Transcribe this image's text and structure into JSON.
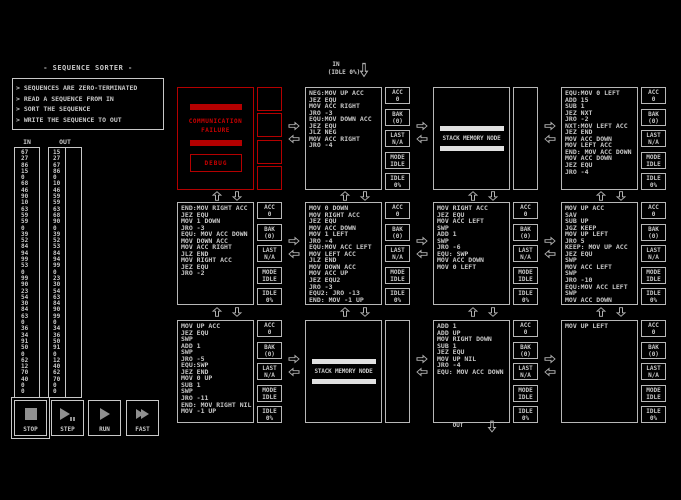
{
  "puzzle": {
    "title": "- SEQUENCE SORTER -",
    "description": [
      "> SEQUENCES ARE ZERO-TERMINATED",
      "> READ A SEQUENCE FROM IN",
      "> SORT THE SEQUENCE",
      "> WRITE THE SEQUENCE TO OUT"
    ]
  },
  "io": {
    "in_label": "IN",
    "out_label": "OUT",
    "in_values": [
      67,
      27,
      86,
      15,
      0,
      68,
      46,
      90,
      10,
      63,
      59,
      59,
      0,
      39,
      52,
      84,
      94,
      99,
      53,
      0,
      99,
      90,
      23,
      54,
      30,
      84,
      63,
      0,
      36,
      34,
      91,
      50,
      0,
      62,
      12,
      70,
      40,
      0,
      0
    ],
    "out_expected": [
      15,
      27,
      67,
      86,
      0,
      10,
      46,
      59,
      59,
      63,
      68,
      90,
      0,
      39,
      52,
      53,
      84,
      94,
      99,
      0,
      23,
      30,
      54,
      63,
      84,
      90,
      99,
      0,
      34,
      36,
      50,
      91,
      0,
      12,
      40,
      62,
      70,
      0,
      0
    ],
    "out_actual": []
  },
  "ports": {
    "in": {
      "label": "IN",
      "status": "(IDLE 0%)"
    },
    "out": {
      "label": "OUT"
    }
  },
  "status_labels": {
    "acc": "ACC",
    "bak": "BAK",
    "last": "LAST",
    "mode": "MODE",
    "idle": "IDLE"
  },
  "controls": [
    {
      "id": "stop",
      "label": "STOP",
      "active": true
    },
    {
      "id": "step",
      "label": "STEP",
      "active": false
    },
    {
      "id": "run",
      "label": "RUN",
      "active": false
    },
    {
      "id": "fast",
      "label": "FAST",
      "active": false
    }
  ],
  "nodes": [
    {
      "row": 0,
      "col": 0,
      "type": "corrupt",
      "lines": [
        "COMMUNICATION",
        "FAILURE"
      ],
      "button": "DEBUG"
    },
    {
      "row": 0,
      "col": 1,
      "type": "code",
      "code": [
        "NEG:MOV UP ACC",
        "JEZ EQU",
        "MOV ACC RIGHT",
        "JRO -3",
        "EQU:MOV DOWN ACC",
        "JEZ EQU",
        "JLZ NEG",
        "MOV ACC RIGHT",
        "JRO -4"
      ],
      "status": {
        "acc": "0",
        "bak": "(0)",
        "last": "N/A",
        "mode": "IDLE",
        "idle": "0%"
      }
    },
    {
      "row": 0,
      "col": 2,
      "type": "stack",
      "label": "STACK MEMORY NODE"
    },
    {
      "row": 0,
      "col": 3,
      "type": "code",
      "code": [
        "EQU:MOV 0 LEFT",
        "ADD 15",
        "SUB 1",
        "JEZ NXT",
        "JRO -2",
        "NXT:MOV LEFT ACC",
        "JEZ END",
        "MOV ACC DOWN",
        "MOV LEFT ACC",
        "END: MOV ACC DOWN",
        "MOV ACC DOWN",
        "JEZ EQU",
        "JRO -4"
      ],
      "status": {
        "acc": "0",
        "bak": "(0)",
        "last": "N/A",
        "mode": "IDLE",
        "idle": "0%"
      }
    },
    {
      "row": 1,
      "col": 0,
      "type": "code",
      "code": [
        "END:MOV RIGHT ACC",
        "JEZ EQU",
        "MOV 1 DOWN",
        "JRO -3",
        "EQU: MOV ACC DOWN",
        "MOV DOWN ACC",
        "MOV ACC RIGHT",
        "JLZ END",
        "MOV RIGHT ACC",
        "JEZ EQU",
        "JRO -2"
      ],
      "status": {
        "acc": "0",
        "bak": "(0)",
        "last": "N/A",
        "mode": "IDLE",
        "idle": "0%"
      }
    },
    {
      "row": 1,
      "col": 1,
      "type": "code",
      "code": [
        "MOV 0 DOWN",
        "MOV RIGHT ACC",
        "JEZ EQU",
        "MOV ACC DOWN",
        "MOV 1 LEFT",
        "JRO -4",
        "EQU:MOV ACC LEFT",
        "MOV LEFT ACC",
        "JLZ END",
        "MOV DOWN ACC",
        "MOV ACC UP",
        "JEZ EQU2",
        "JRO -3",
        "EQU2: JRO -13",
        "END: MOV -1 UP"
      ],
      "status": {
        "acc": "0",
        "bak": "(0)",
        "last": "N/A",
        "mode": "IDLE",
        "idle": "0%"
      }
    },
    {
      "row": 1,
      "col": 2,
      "type": "code",
      "code": [
        "MOV RIGHT ACC",
        "JEZ EQU",
        "MOV ACC LEFT",
        "SWP",
        "ADD 1",
        "SWP",
        "JRO -6",
        "EQU: SWP",
        "MOV ACC DOWN",
        "MOV 0 LEFT"
      ],
      "status": {
        "acc": "0",
        "bak": "(0)",
        "last": "N/A",
        "mode": "IDLE",
        "idle": "0%"
      }
    },
    {
      "row": 1,
      "col": 3,
      "type": "code",
      "code": [
        "MOV UP ACC",
        "SAV",
        "SUB UP",
        "JGZ KEEP",
        "MOV UP LEFT",
        "JRO 5",
        "KEEP: MOV UP ACC",
        "JEZ EQU",
        "SWP",
        "MOV ACC LEFT",
        "SWP",
        "JRO -10",
        "EQU:MOV ACC LEFT",
        "SWP",
        "MOV ACC DOWN"
      ],
      "status": {
        "acc": "0",
        "bak": "(0)",
        "last": "N/A",
        "mode": "IDLE",
        "idle": "0%"
      }
    },
    {
      "row": 2,
      "col": 0,
      "type": "code",
      "code": [
        "MOV UP ACC",
        "JEZ EQU",
        "SWP",
        "ADD 1",
        "SWP",
        "JRO -5",
        "EQU:SWP",
        "JEZ END",
        "MOV 0 UP",
        "SUB 1",
        "SWP",
        "JRO -11",
        "END: MOV RIGHT NIL",
        "MOV -1 UP"
      ],
      "status": {
        "acc": "0",
        "bak": "(0)",
        "last": "N/A",
        "mode": "IDLE",
        "idle": "0%"
      }
    },
    {
      "row": 2,
      "col": 1,
      "type": "stack",
      "label": "STACK MEMORY NODE"
    },
    {
      "row": 2,
      "col": 2,
      "type": "code",
      "code": [
        "ADD 1",
        "ADD UP",
        "MOV RIGHT DOWN",
        "SUB 1",
        "JEZ EQU",
        "MOV UP NIL",
        "JRO -4",
        "EQU: MOV ACC DOWN"
      ],
      "status": {
        "acc": "0",
        "bak": "(0)",
        "last": "N/A",
        "mode": "IDLE",
        "idle": "0%"
      }
    },
    {
      "row": 2,
      "col": 3,
      "type": "code",
      "code": [
        "MOV UP LEFT"
      ],
      "status": {
        "acc": "0",
        "bak": "(0)",
        "last": "N/A",
        "mode": "IDLE",
        "idle": "0%"
      }
    }
  ],
  "colors": {
    "background": "#000000",
    "foreground": "#c8c8c8",
    "error_red": "#c00000"
  }
}
